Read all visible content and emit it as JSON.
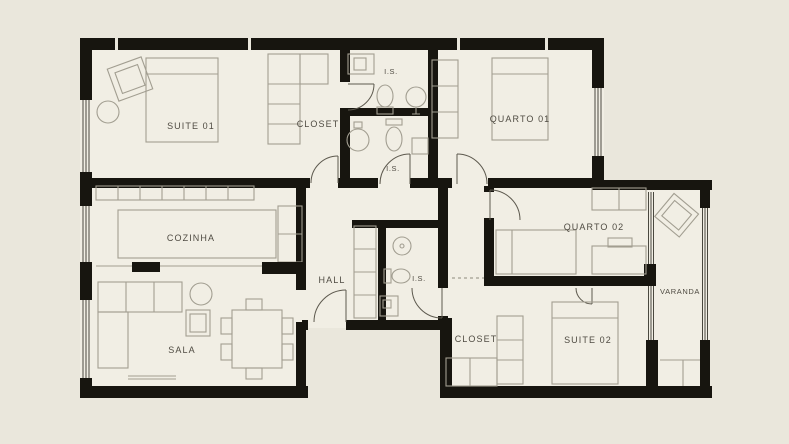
{
  "rooms": {
    "suite01": "SUITE 01",
    "closet1": "CLOSET",
    "is1": "I.S.",
    "is2": "I.S.",
    "quarto01": "QUARTO 01",
    "cozinha": "COZINHA",
    "hall": "HALL",
    "is3": "I.S.",
    "quarto02": "QUARTO 02",
    "varanda": "VARANDA",
    "sala": "SALA",
    "closet2": "CLOSET",
    "suite02": "SUITE 02"
  },
  "colors": {
    "background": "#eae7dc",
    "floor": "#f1eee4",
    "wall": "#17150f",
    "furniture": "#a29e91",
    "label": "#4f4b42",
    "windowline": "#4a483f"
  }
}
